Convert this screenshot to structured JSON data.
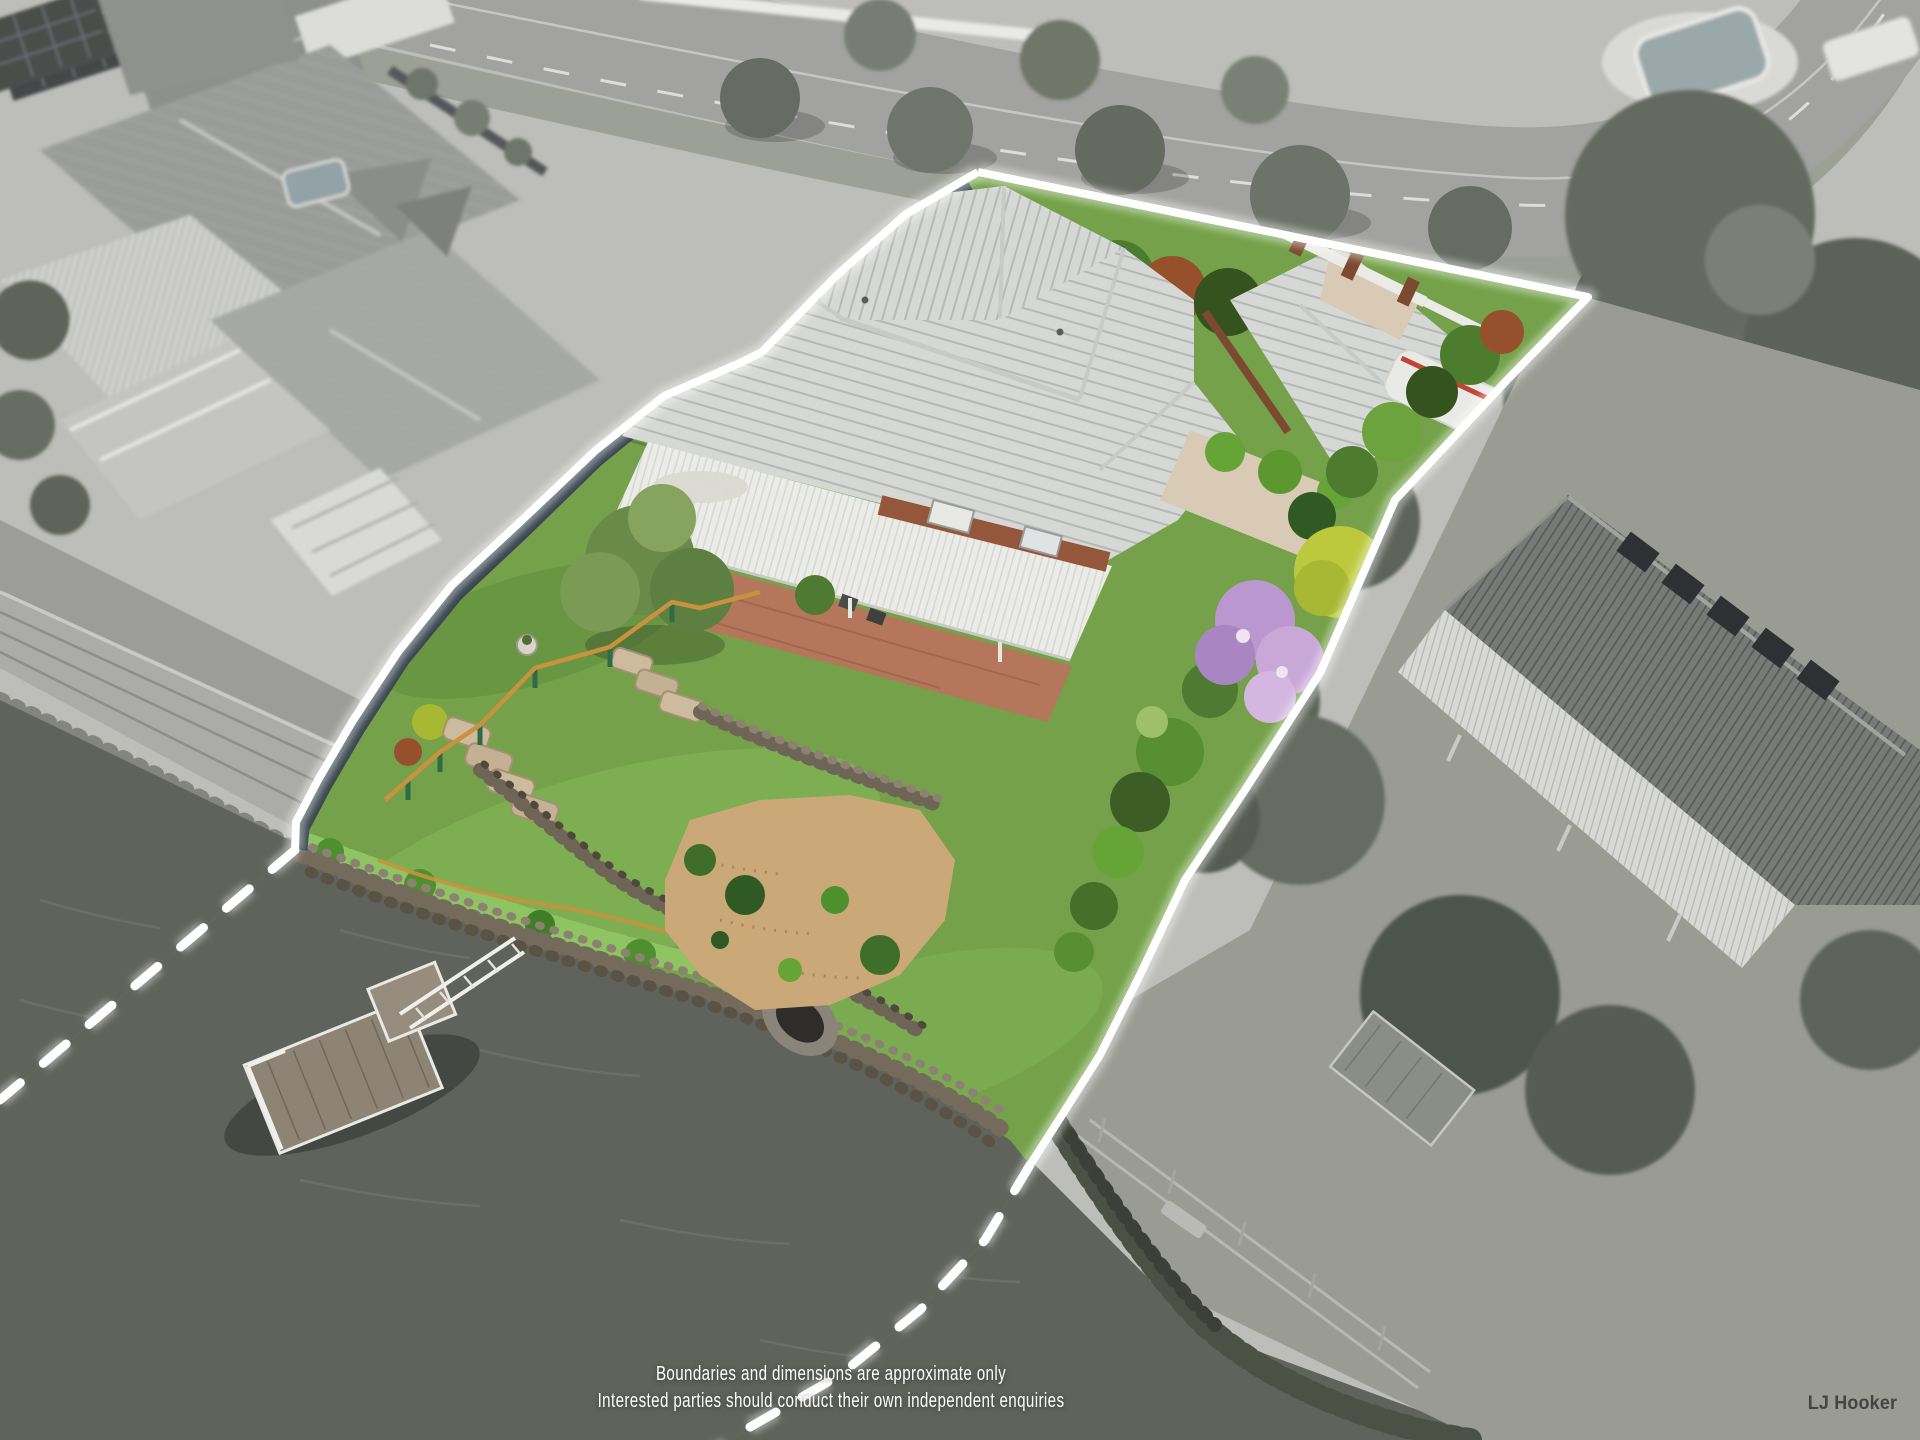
{
  "overlay": {
    "disclaimer_line_1": "Boundaries and dimensions are approximate only",
    "disclaimer_line_2": "Interested parties should conduct their own independent enquiries",
    "brand_watermark": "LJ Hooker"
  },
  "boundary": {
    "style": "solid white line on land, dashed white line across water",
    "west_solid_path": "M 978,172 L 906,214 L 836,276 L 762,352 L 742,362 L 664,396 L 596,450 L 520,522 L 452,585 L 398,652 L 352,722 L 318,780 L 296,822 L 295,850",
    "north_east_solid_path": "M 978,172 L 1588,297 L 1507,380 L 1395,500 L 1320,673 L 1245,790 L 1185,880 L 1140,975 L 1100,1055 L 1062,1115 L 1030,1165",
    "southwest_dashed_path": "M 295,850 L 150,973 L 0,1100",
    "southeast_dashed_path": "M 1030,1165 L 985,1240 L 920,1310 L 840,1375 L 745,1430 L 700,1465"
  },
  "colors": {
    "line_white": "#ffffff",
    "water": "#60635c",
    "water_light": "#7e817a",
    "road": "#a2a2a0",
    "land_gray": "#bdbdb9",
    "seawall": "#abaca7",
    "lawn_gray": "#9a9c94",
    "tree_gray": "#646a60",
    "tree_dark_gray": "#4e544b",
    "neighbor_roof": "#787a77",
    "awning_white": "#d8d9d5",
    "left_roof": "#9a9c99",
    "fence_navy": "#3a4550",
    "grass": "#74a149",
    "grass_bright": "#82b557",
    "grass_light": "#8fc463",
    "hedge_dark": "#35531f",
    "hedge_green": "#639a38",
    "hedge_rust": "#96502c",
    "hedge_bronze": "#8a6a34",
    "croton_yellow": "#bcc93c",
    "flower_purple": "#bb97cf",
    "tile_roof": "#d6d8d5",
    "tile_line": "#a8adac",
    "patio_white": "#ebece7",
    "brick_paving": "#b4775c",
    "brick_wall": "#94573b",
    "sand": "#cba877",
    "rock": "#7a7061",
    "rock_light": "#cdbb9e",
    "timber": "#c8923f",
    "rail_green": "#2f6b45",
    "pontoon": "#8e8476",
    "caravan_red": "#c04434",
    "text_white": "#ffffff",
    "logo_dark": "#3b3b39"
  }
}
